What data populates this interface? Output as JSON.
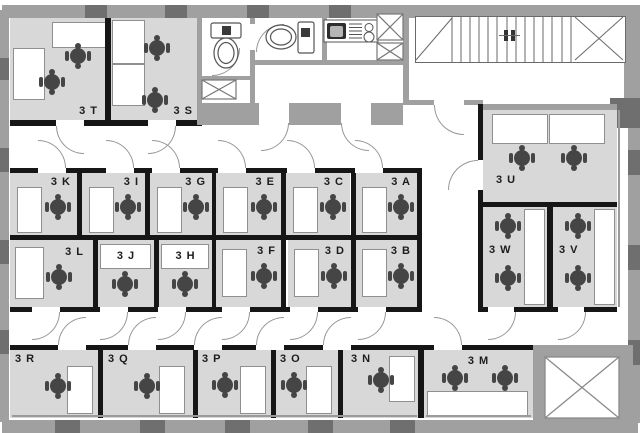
{
  "colors": {
    "room_fill": "#d8d8d8",
    "corridor": "#ffffff",
    "wall_dark": "#161616",
    "wall_gray": "#a0a0a0",
    "mullion_dark": "#6f6f6f",
    "chair": "#454545",
    "line": "#979797"
  },
  "rooms": {
    "3A": {
      "label": "3 A",
      "chairs": 1,
      "desks": 1
    },
    "3B": {
      "label": "3 B",
      "chairs": 1,
      "desks": 1
    },
    "3C": {
      "label": "3 C",
      "chairs": 1,
      "desks": 1
    },
    "3D": {
      "label": "3 D",
      "chairs": 1,
      "desks": 1
    },
    "3E": {
      "label": "3 E",
      "chairs": 1,
      "desks": 1
    },
    "3F": {
      "label": "3 F",
      "chairs": 1,
      "desks": 1
    },
    "3G": {
      "label": "3 G",
      "chairs": 1,
      "desks": 1
    },
    "3H": {
      "label": "3 H",
      "chairs": 1,
      "desks": 1
    },
    "3I": {
      "label": "3 I",
      "chairs": 1,
      "desks": 1
    },
    "3J": {
      "label": "3 J",
      "chairs": 1,
      "desks": 1
    },
    "3K": {
      "label": "3 K",
      "chairs": 1,
      "desks": 1
    },
    "3L": {
      "label": "3 L",
      "chairs": 1,
      "desks": 1
    },
    "3M": {
      "label": "3 M",
      "chairs": 2,
      "desks": 1
    },
    "3N": {
      "label": "3 N",
      "chairs": 1,
      "desks": 1
    },
    "3O": {
      "label": "3 O",
      "chairs": 1,
      "desks": 1
    },
    "3P": {
      "label": "3 P",
      "chairs": 1,
      "desks": 1
    },
    "3Q": {
      "label": "3 Q",
      "chairs": 1,
      "desks": 1
    },
    "3R": {
      "label": "3 R",
      "chairs": 1,
      "desks": 1
    },
    "3S": {
      "label": "3 S",
      "chairs": 2,
      "desks": 2
    },
    "3T": {
      "label": "3 T",
      "chairs": 2,
      "desks": 2
    },
    "3U": {
      "label": "3 U",
      "chairs": 2,
      "desks": 2
    },
    "3V": {
      "label": "3 V",
      "chairs": 2,
      "desks": 1
    },
    "3W": {
      "label": "3 W",
      "chairs": 2,
      "desks": 1
    }
  },
  "facilities": {
    "toilets": 2,
    "kitchen_sinks": 1,
    "burners": 2,
    "stairs": 1,
    "elevators": 1,
    "service_shafts": 3
  },
  "icons": {
    "chair": "office-chair-icon",
    "toilet": "toilet-icon",
    "sink": "kitchen-sink-icon",
    "stairs": "stairs-icon",
    "elevator": "elevator-shaft-icon",
    "shaft": "duct-shaft-icon",
    "door": "door-swing-icon"
  }
}
